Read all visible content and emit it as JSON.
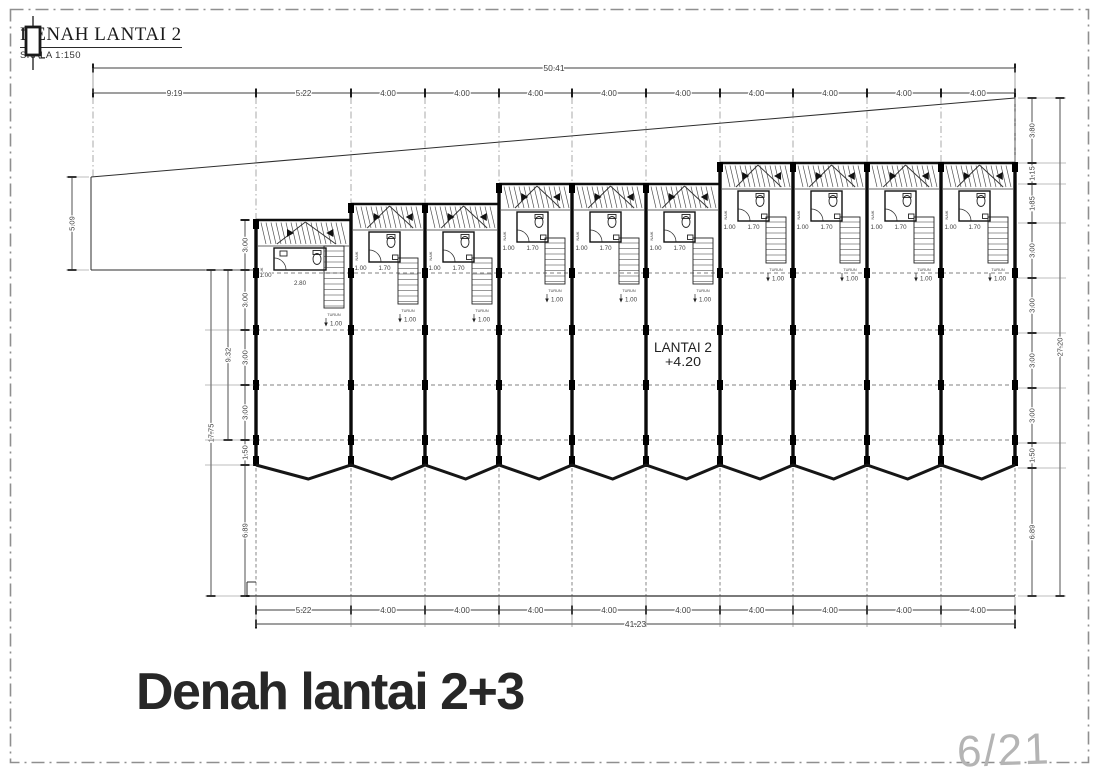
{
  "title_block": {
    "title": "DENAH LANTAI 2",
    "scale": "SKALA  1:150"
  },
  "floor_label": {
    "line1": "LANTAI  2",
    "line2": "+4.20"
  },
  "footer": {
    "title": "Denah lantai 2+3",
    "page_number": "6/21"
  },
  "colors": {
    "ink": "#1a1a1a",
    "dim": "#3f3f3f",
    "border": "#8f8f8f",
    "page_number": "#b4b4b4"
  },
  "plan": {
    "walls_x": [
      256,
      351,
      425,
      499,
      572,
      646,
      720,
      793,
      867,
      941,
      1015
    ],
    "unit_tops": [
      220,
      204,
      204,
      184,
      184,
      184,
      163,
      163,
      163,
      163
    ],
    "unit_labels": {
      "naik": "NAIK",
      "turun": "TURUN",
      "dim_side": "1.00",
      "dim_bath": "1.70",
      "dim_bath_first": "2.80",
      "dim_turun": "1.00"
    },
    "floor_dashes_y": [
      273,
      330,
      385,
      440
    ],
    "zigzag": {
      "y": 465,
      "dip": 479,
      "frac": 0.55
    },
    "bottom_y": 596,
    "site": {
      "diagonal": [
        91,
        177,
        1015,
        98
      ],
      "left_edge": [
        91,
        177,
        91,
        270
      ],
      "front_line_y": 270
    },
    "dims": {
      "top_total": {
        "y": 68,
        "x1": 93,
        "x2": 1015,
        "label": "50.41"
      },
      "top_row": {
        "y": 93,
        "ticks": [
          93,
          256,
          351,
          425,
          499,
          572,
          646,
          720,
          793,
          867,
          941,
          1015
        ],
        "labels": [
          "9.19",
          "5.22",
          "4.00",
          "4.00",
          "4.00",
          "4.00",
          "4.00",
          "4.00",
          "4.00",
          "4.00",
          "4.00"
        ]
      },
      "bottom_row": {
        "y": 610,
        "ticks": [
          256,
          351,
          425,
          499,
          572,
          646,
          720,
          793,
          867,
          941,
          1015
        ],
        "labels": [
          "5.22",
          "4.00",
          "4.00",
          "4.00",
          "4.00",
          "4.00",
          "4.00",
          "4.00",
          "4.00",
          "4.00"
        ]
      },
      "bottom_total": {
        "y": 624,
        "x1": 256,
        "x2": 1015,
        "label": "41.23"
      },
      "left_cols": [
        {
          "x": 72,
          "segs": [
            [
              177,
              270,
              "5.09"
            ]
          ]
        },
        {
          "x": 245,
          "segs": [
            [
              220,
              270,
              "3.00"
            ],
            [
              270,
              330,
              "3.00"
            ],
            [
              330,
              385,
              "3.00"
            ],
            [
              385,
              440,
              "3.00"
            ],
            [
              440,
              465,
              "1.50"
            ],
            [
              465,
              596,
              "6.89"
            ]
          ]
        },
        {
          "x": 228,
          "segs": [
            [
              270,
              440,
              "9.32"
            ]
          ]
        },
        {
          "x": 211,
          "segs": [
            [
              270,
              596,
              "17.75"
            ]
          ]
        }
      ],
      "right_cols": [
        {
          "x": 1032,
          "segs": [
            [
              98,
              163,
              "3.80"
            ],
            [
              163,
              184,
              "1.15"
            ],
            [
              184,
              223,
              "1.85"
            ],
            [
              223,
              278,
              "3.00"
            ],
            [
              278,
              333,
              "3.00"
            ],
            [
              333,
              388,
              "3.00"
            ],
            [
              388,
              443,
              "3.00"
            ],
            [
              443,
              468,
              "1.50"
            ],
            [
              468,
              596,
              "6.89"
            ]
          ]
        },
        {
          "x": 1060,
          "segs": [
            [
              98,
              596,
              "27.20"
            ]
          ]
        }
      ]
    }
  }
}
